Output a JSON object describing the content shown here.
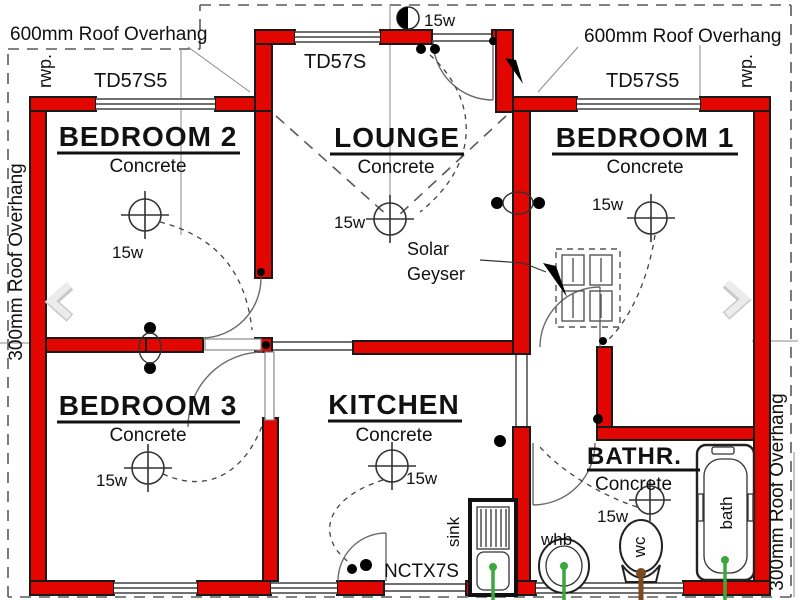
{
  "plan": {
    "overhang": {
      "top_left": "600mm Roof Overhang",
      "top_right": "600mm Roof Overhang",
      "left": "300mm Roof Overhang",
      "right": "300mm Roof Overhang"
    },
    "rwp": {
      "left": "rwp.",
      "right": "rwp."
    },
    "trusses": {
      "left": "TD57S5",
      "center": "TD57S",
      "right": "TD57S5"
    },
    "lintel": "NCTX7S",
    "exterior_light": "15w",
    "solar_geyser": {
      "line1": "Solar",
      "line2": "Geyser"
    },
    "rooms": {
      "bedroom2": {
        "name": "BEDROOM 2",
        "floor": "Concrete",
        "light": "15w"
      },
      "lounge": {
        "name": "LOUNGE",
        "floor": "Concrete",
        "light": "15w"
      },
      "bedroom1": {
        "name": "BEDROOM 1",
        "floor": "Concrete",
        "light": "15w"
      },
      "bedroom3": {
        "name": "BEDROOM 3",
        "floor": "Concrete",
        "light": "15w"
      },
      "kitchen": {
        "name": "KITCHEN",
        "floor": "Concrete",
        "light": "15w"
      },
      "bathroom": {
        "name": "BATHR.",
        "floor": "Concrete",
        "light": "15w"
      }
    },
    "fixtures": {
      "sink": "sink",
      "whb": "whb",
      "wc": "wc",
      "bath": "bath"
    },
    "colors": {
      "wall_red": "#e10600",
      "water_pipe_green": "#3aa83a",
      "soil_pipe_brown": "#7a4a21",
      "dashed_line": "#5a5a5a",
      "chevron_gray": "#e3e3e3"
    }
  }
}
